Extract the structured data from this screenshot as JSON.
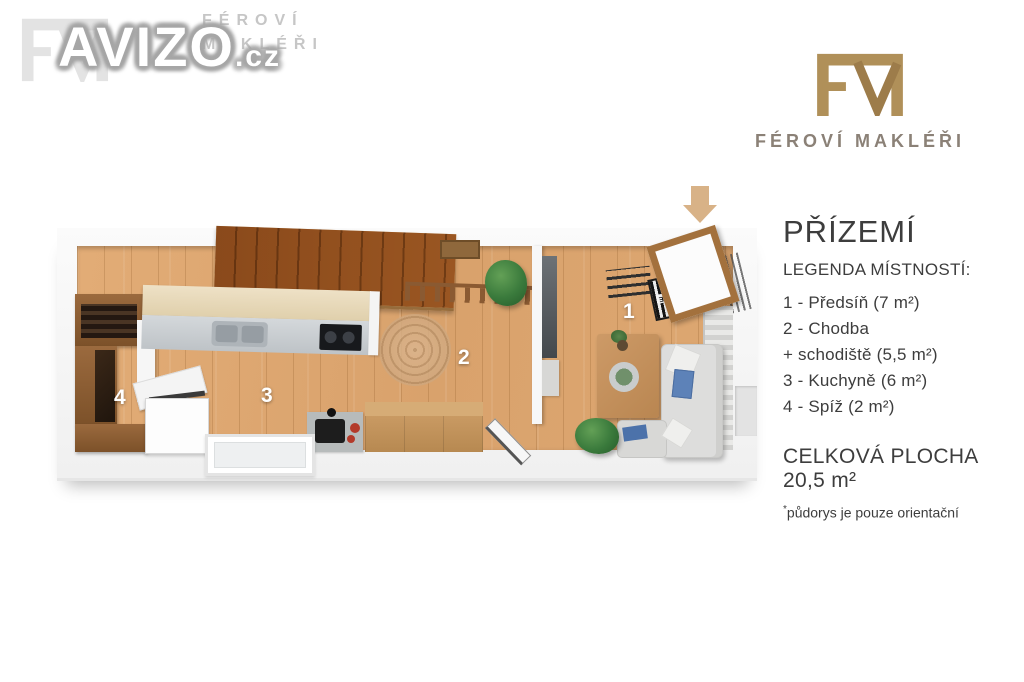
{
  "watermark": {
    "brand": "AVIZO",
    "tld": ".cz",
    "ghost_line1": "FÉROVÍ",
    "ghost_line2": "MAKLÉŘI"
  },
  "brand": {
    "monogram": "FM",
    "name": "FÉROVÍ MAKLÉŘI",
    "gold_color": "#ad8a55",
    "name_color": "#8b8177"
  },
  "panel": {
    "title": "PŘÍZEMÍ",
    "legend_heading": "LEGENDA MÍSTNOSTÍ:",
    "legend_items": [
      "1 - Předsíň (7 m²)",
      "2 - Chodba",
      "+ schodiště (5,5 m²)",
      "3 - Kuchyně (6 m²)",
      "4 - Spíž (2 m²)"
    ],
    "total_label": "CELKOVÁ PLOCHA 20,5 m²",
    "note_star": "*",
    "note_text": "půdorys je pouze orientační",
    "text_color": "#3d3d3d"
  },
  "plan": {
    "room_numbers": [
      "1",
      "2",
      "3",
      "4"
    ],
    "welcome_mat_text": "WELCOME",
    "entry_arrow_color": "#d8b287",
    "floor_color": "#dda873"
  }
}
